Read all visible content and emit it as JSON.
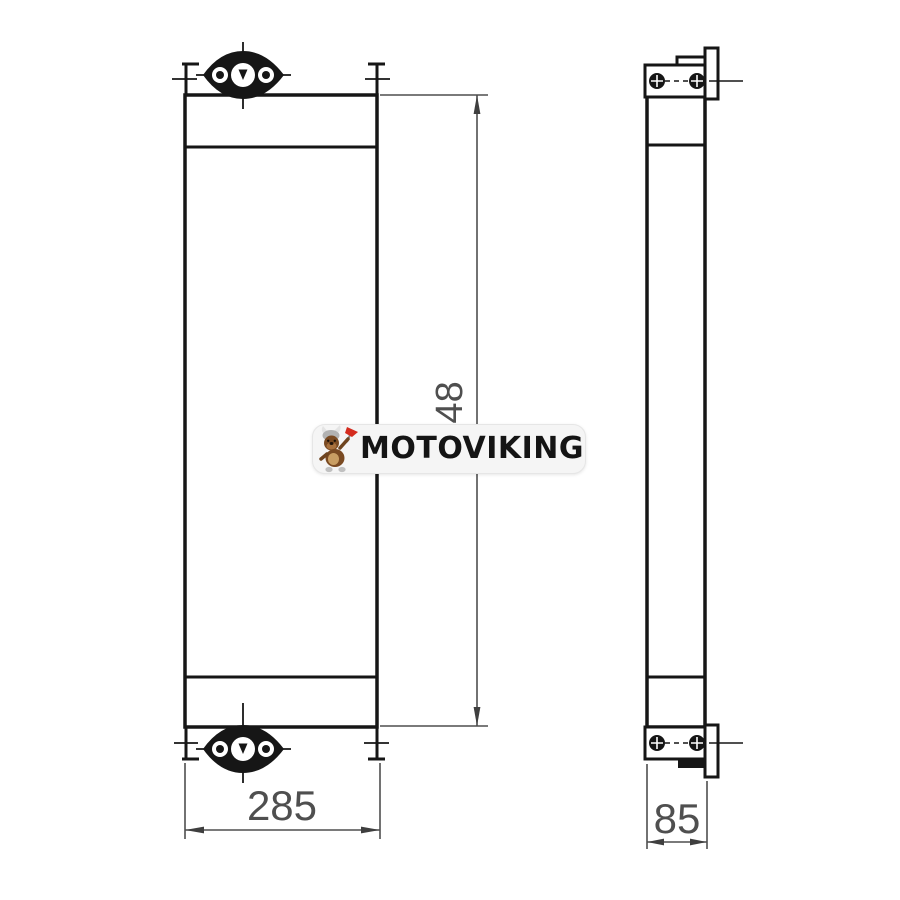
{
  "dimensions": {
    "width": "285",
    "depth": "85",
    "height": "948"
  },
  "watermark": {
    "brand": "MOTOVIKING"
  },
  "icons": {
    "mascot": "viking-mascot-icon",
    "top_flange": "port-flange-icon",
    "bottom_flange": "port-flange-icon"
  },
  "colors": {
    "outline": "#161616",
    "dimension": "#4f4f4f",
    "watermark_bg": "#f5f5f5",
    "brand_text": "#141414",
    "mascot_axe": "#d42b1e",
    "mascot_body": "#7a4a22",
    "mascot_helmet": "#b2b2b2"
  }
}
